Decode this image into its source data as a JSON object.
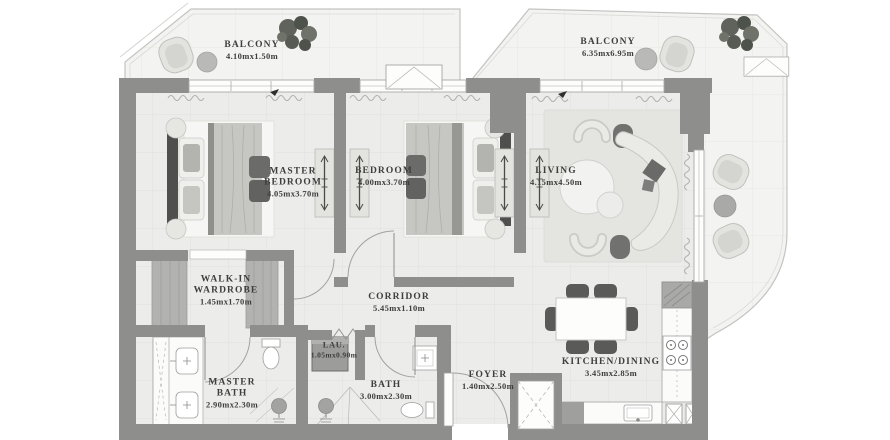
{
  "plan": {
    "rooms": [
      {
        "id": "balcony-1",
        "name": "BALCONY",
        "dims": "4.10mx1.50m"
      },
      {
        "id": "balcony-2",
        "name": "BALCONY",
        "dims": "6.35mx6.95m"
      },
      {
        "id": "master-bedroom",
        "name": "MASTER BEDROOM",
        "dims": "4.05mx3.70m"
      },
      {
        "id": "bedroom",
        "name": "BEDROOM",
        "dims": "4.00mx3.70m"
      },
      {
        "id": "living",
        "name": "LIVING",
        "dims": "4.15mx4.50m"
      },
      {
        "id": "walk-in-wardrobe",
        "name": "WALK-IN WARDROBE",
        "dims": "1.45mx1.70m"
      },
      {
        "id": "corridor",
        "name": "CORRIDOR",
        "dims": "5.45mx1.10m"
      },
      {
        "id": "laundry",
        "name": "LAU.",
        "dims": "1.05mx0.90m"
      },
      {
        "id": "master-bath",
        "name": "MASTER BATH",
        "dims": "2.90mx2.30m"
      },
      {
        "id": "bath",
        "name": "BATH",
        "dims": "3.00mx2.30m"
      },
      {
        "id": "foyer",
        "name": "FOYER",
        "dims": "1.40mx2.50m"
      },
      {
        "id": "kitchen-dining",
        "name": "KITCHEN/DINING",
        "dims": "3.45mx2.85m"
      }
    ],
    "colors": {
      "wall": "#8e8e8c",
      "interior_floor": "#ececea",
      "balcony_floor": "#f3f3f1",
      "label_text": "#3e3e3c",
      "plant": "#5d615a",
      "furniture_dark": "#5a5a58"
    }
  }
}
